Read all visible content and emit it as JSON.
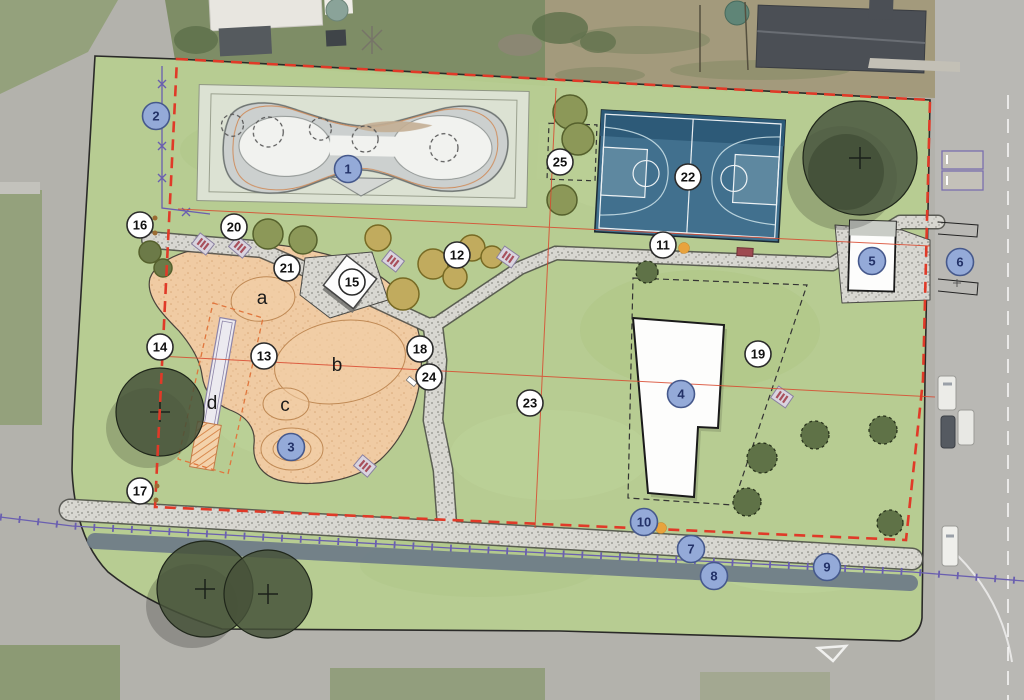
{
  "plan_markers": {
    "numbered_blue": [
      {
        "label": "1",
        "x": 348,
        "y": 169
      },
      {
        "label": "2",
        "x": 156,
        "y": 116
      },
      {
        "label": "3",
        "x": 291,
        "y": 447
      },
      {
        "label": "4",
        "x": 681,
        "y": 394
      },
      {
        "label": "5",
        "x": 872,
        "y": 261
      },
      {
        "label": "6",
        "x": 960,
        "y": 262
      },
      {
        "label": "7",
        "x": 691,
        "y": 549
      },
      {
        "label": "8",
        "x": 714,
        "y": 576
      },
      {
        "label": "9",
        "x": 827,
        "y": 567
      },
      {
        "label": "10",
        "x": 644,
        "y": 522
      }
    ],
    "numbered_white": [
      {
        "label": "11",
        "x": 663,
        "y": 245
      },
      {
        "label": "12",
        "x": 457,
        "y": 255
      },
      {
        "label": "13",
        "x": 264,
        "y": 356
      },
      {
        "label": "14",
        "x": 160,
        "y": 347
      },
      {
        "label": "15",
        "x": 352,
        "y": 282
      },
      {
        "label": "16",
        "x": 140,
        "y": 225
      },
      {
        "label": "17",
        "x": 140,
        "y": 491
      },
      {
        "label": "18",
        "x": 420,
        "y": 349
      },
      {
        "label": "19",
        "x": 758,
        "y": 354
      },
      {
        "label": "20",
        "x": 234,
        "y": 227
      },
      {
        "label": "21",
        "x": 287,
        "y": 268
      },
      {
        "label": "22",
        "x": 688,
        "y": 177
      },
      {
        "label": "23",
        "x": 530,
        "y": 403
      },
      {
        "label": "24",
        "x": 429,
        "y": 377
      },
      {
        "label": "25",
        "x": 560,
        "y": 162
      }
    ],
    "letters": [
      {
        "label": "a",
        "x": 262,
        "y": 297
      },
      {
        "label": "b",
        "x": 337,
        "y": 364
      },
      {
        "label": "c",
        "x": 285,
        "y": 404
      },
      {
        "label": "d",
        "x": 212,
        "y": 402
      }
    ]
  },
  "colors": {
    "boundary_red": "#e03a28",
    "section_line_red": "#d9492f",
    "fence_purple": "#6a5fb0",
    "marker_blue_fill": "#94aad8",
    "marker_blue_stroke": "#46598c",
    "marker_blue_text": "#233268",
    "marker_white_fill": "#ffffff",
    "marker_white_stroke": "#2b2b2b",
    "park_green": "#b7cd90",
    "court_blue": "#41708e",
    "playground_sand": "#f0cba3",
    "path_gravel": "#d7d6d1",
    "existing_path_grey": "#6d7b88",
    "orange_dot": "#e8a33d"
  }
}
